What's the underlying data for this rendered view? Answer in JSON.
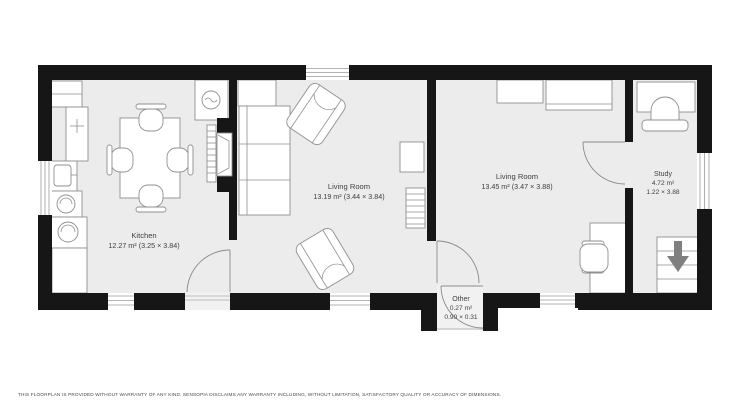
{
  "floorplan": {
    "rooms": [
      {
        "name": "Kitchen",
        "area": "12.27 m² (3.25 × 3.84)"
      },
      {
        "name": "Living Room",
        "area": "13.19 m² (3.44 × 3.84)"
      },
      {
        "name": "Living Room",
        "area": "13.45 m² (3.47 × 3.88)"
      },
      {
        "name": "Study",
        "area": "4.72 m²",
        "dims": "1.22 × 3.88"
      },
      {
        "name": "Other",
        "area": "0.27 m²",
        "dims": "0.90 × 0.31"
      }
    ],
    "stairs": {
      "direction": "down"
    },
    "disclaimer": "THIS FLOORPLAN IS PROVIDED WITHOUT WARRANTY OF ANY KIND. SENSOPIA DISCLAIMS ANY WARRANTY INCLUDING, WITHOUT LIMITATION, SATISFACTORY QUALITY OR ACCURACY OF DIMENSIONS.",
    "colors": {
      "wall": "#161616",
      "floor": "#ececec",
      "label": "#3f3f3f",
      "arrow": "#7f7f7f"
    }
  }
}
